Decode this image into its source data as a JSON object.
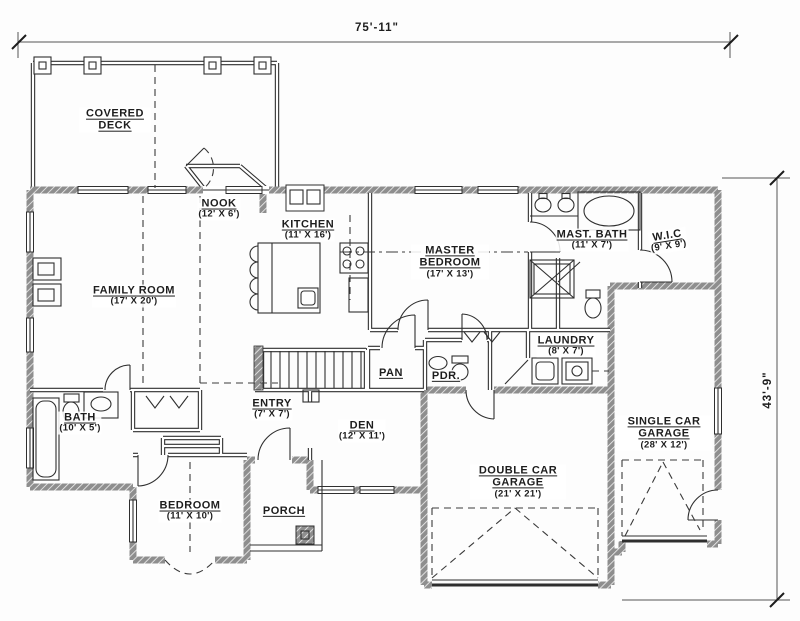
{
  "title": "House floor plan",
  "dimensions": {
    "width_label": "75'-11\"",
    "height_label": "43'-9\""
  },
  "rooms": [
    {
      "id": "covered-deck",
      "name": "COVERED DECK",
      "dims": ""
    },
    {
      "id": "nook",
      "name": "NOOK",
      "dims": "(12' X 6')"
    },
    {
      "id": "kitchen",
      "name": "KITCHEN",
      "dims": "(11' X 16')"
    },
    {
      "id": "family-room",
      "name": "FAMILY ROOM",
      "dims": "(17' X 20')"
    },
    {
      "id": "master-bedroom",
      "name": "MASTER BEDROOM",
      "dims": "(17' X 13')"
    },
    {
      "id": "master-bath",
      "name": "MAST. BATH",
      "dims": "(11' X 7')"
    },
    {
      "id": "walk-in-closet",
      "name": "W.I.C",
      "dims": "(9' X 9')"
    },
    {
      "id": "laundry",
      "name": "LAUNDRY",
      "dims": "(8' X 7')"
    },
    {
      "id": "pantry",
      "name": "PAN",
      "dims": ""
    },
    {
      "id": "powder-room",
      "name": "PDR.",
      "dims": ""
    },
    {
      "id": "entry",
      "name": "ENTRY",
      "dims": "(7' X 7')"
    },
    {
      "id": "den",
      "name": "DEN",
      "dims": "(12' X 11')"
    },
    {
      "id": "bath",
      "name": "BATH",
      "dims": "(10' X 5')"
    },
    {
      "id": "bedroom",
      "name": "BEDROOM",
      "dims": "(11' X 10')"
    },
    {
      "id": "porch",
      "name": "PORCH",
      "dims": ""
    },
    {
      "id": "double-garage",
      "name": "DOUBLE CAR GARAGE",
      "dims": "(21' X 21')"
    },
    {
      "id": "single-garage",
      "name": "SINGLE CAR GARAGE",
      "dims": "(28' X 12')"
    }
  ],
  "colors": {
    "line": "#2f2f2f",
    "wall_hatch": "#8e8e8e",
    "background": "#fdfdfd"
  }
}
